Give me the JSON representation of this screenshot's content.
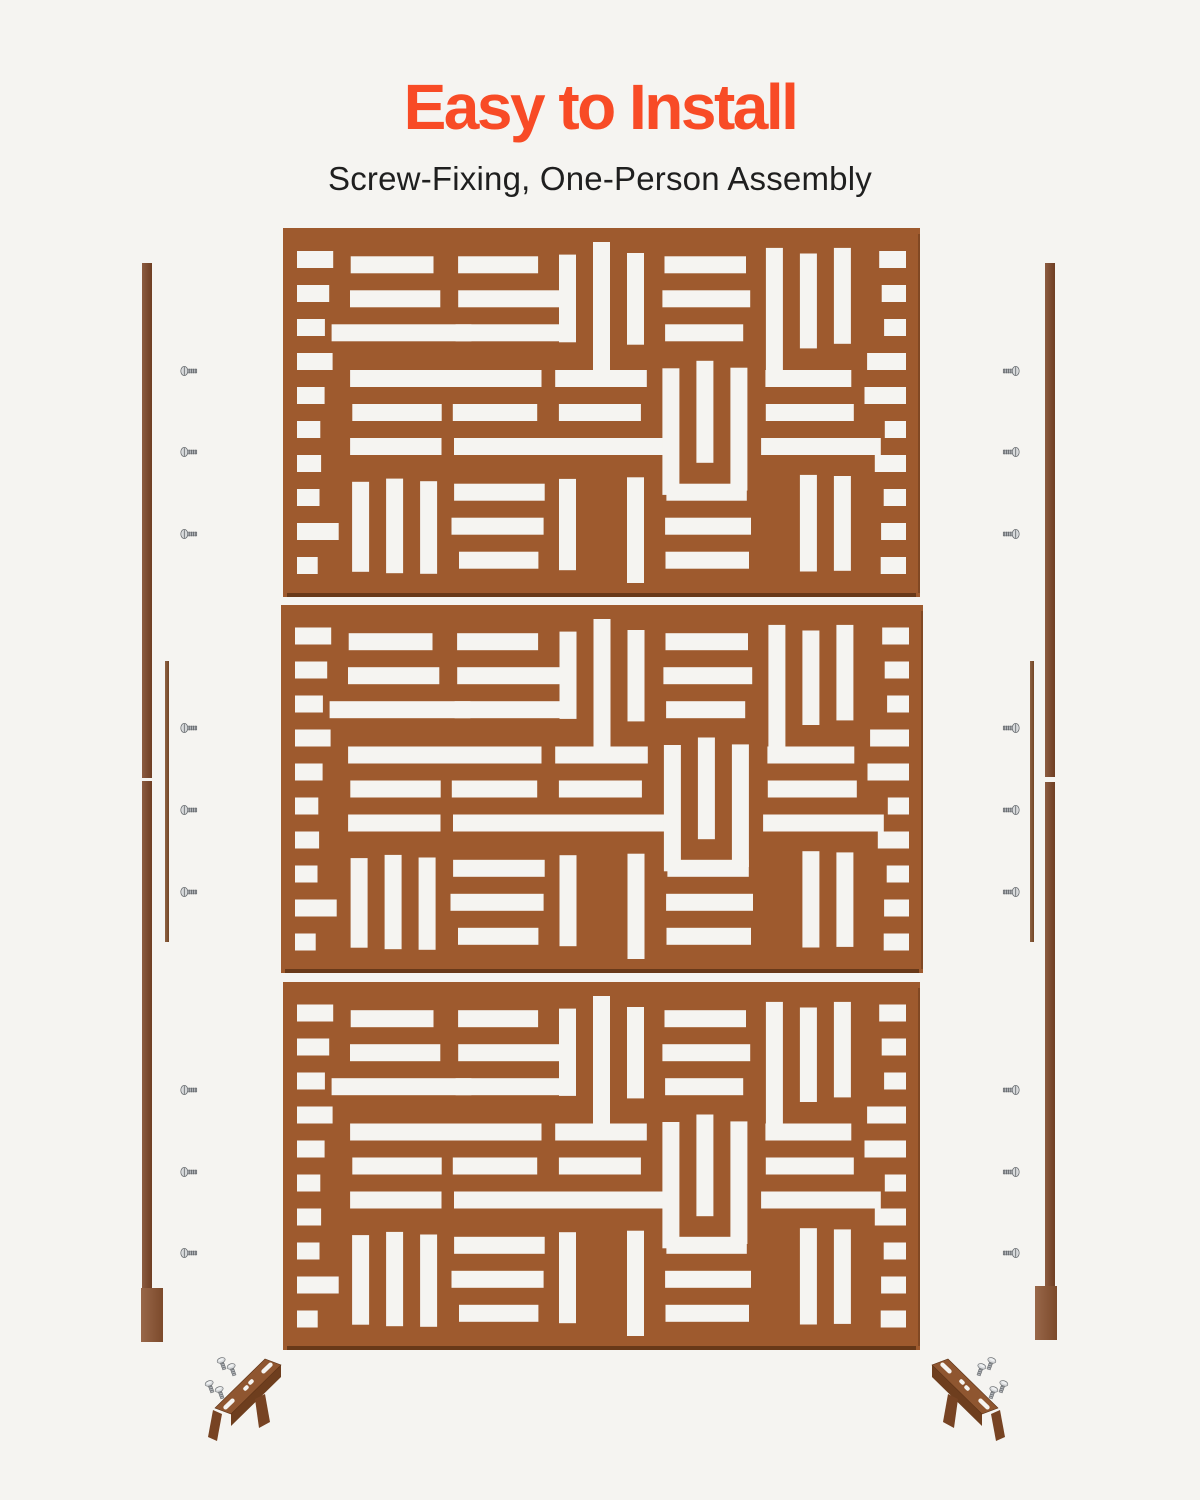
{
  "page": {
    "width": 1200,
    "height": 1500,
    "background": "#f5f4f1"
  },
  "header": {
    "title": "Easy to Install",
    "subtitle": "Screw-Fixing, One-Person Assembly"
  },
  "colors": {
    "title": "#f84b26",
    "subtitle": "#1f1f1f",
    "panel": "#9e5a2e",
    "panel_edge": "#643618",
    "cutout": "#f5f4f1",
    "post": "#7b4526",
    "foot": "#8a5230",
    "joiner": "#7f4d2a",
    "bracket_top": "#8f5630",
    "bracket_front": "#6e3e1e",
    "bracket_leg": "#774323",
    "screw_fill": "#d8dadc",
    "screw_shade": "#b3b6ba",
    "screw_edge": "#606468"
  },
  "panels": {
    "pattern": {
      "unit": 17,
      "margin": 14,
      "seed": 20,
      "ladder_width_units": 2
    },
    "items": [
      {
        "name": "screen-panel-top",
        "x": 283,
        "y": 228,
        "w": 637,
        "h": 369
      },
      {
        "name": "screen-panel-middle",
        "x": 281,
        "y": 605,
        "w": 642,
        "h": 368
      },
      {
        "name": "screen-panel-bottom",
        "x": 283,
        "y": 982,
        "w": 637,
        "h": 368
      }
    ]
  },
  "posts": {
    "left": {
      "segments": [
        {
          "name": "left-post-upper",
          "x": 142,
          "y": 263,
          "w": 10,
          "h": 515,
          "kind": "post"
        },
        {
          "name": "left-post-lower",
          "x": 142,
          "y": 781,
          "w": 10,
          "h": 507,
          "kind": "post"
        },
        {
          "name": "left-joiner-bar",
          "x": 165,
          "y": 661,
          "w": 4,
          "h": 281,
          "kind": "joiner"
        },
        {
          "name": "left-post-foot",
          "x": 141,
          "y": 1288,
          "w": 22,
          "h": 54,
          "kind": "foot"
        }
      ]
    },
    "right": {
      "segments": [
        {
          "name": "right-post-upper",
          "x": 1045,
          "y": 263,
          "w": 10,
          "h": 514,
          "kind": "post"
        },
        {
          "name": "right-post-lower",
          "x": 1045,
          "y": 782,
          "w": 10,
          "h": 506,
          "kind": "post"
        },
        {
          "name": "right-joiner-bar",
          "x": 1030,
          "y": 661,
          "w": 4,
          "h": 281,
          "kind": "joiner"
        },
        {
          "name": "right-post-foot",
          "x": 1035,
          "y": 1286,
          "w": 22,
          "h": 54,
          "kind": "foot"
        }
      ]
    }
  },
  "screws": {
    "left": {
      "x": 180,
      "dir": "right",
      "ys": [
        371,
        452,
        534,
        728,
        810,
        892,
        1090,
        1172,
        1253
      ]
    },
    "right": {
      "x": 1000,
      "dir": "left",
      "ys": [
        371,
        452,
        534,
        728,
        810,
        892,
        1090,
        1172,
        1253
      ]
    }
  },
  "brackets": {
    "items": [
      {
        "name": "base-bracket-left",
        "x": 195,
        "y": 1344,
        "w": 120,
        "h": 112,
        "mirror": false
      },
      {
        "name": "base-bracket-right",
        "x": 898,
        "y": 1344,
        "w": 120,
        "h": 112,
        "mirror": true
      }
    ]
  }
}
